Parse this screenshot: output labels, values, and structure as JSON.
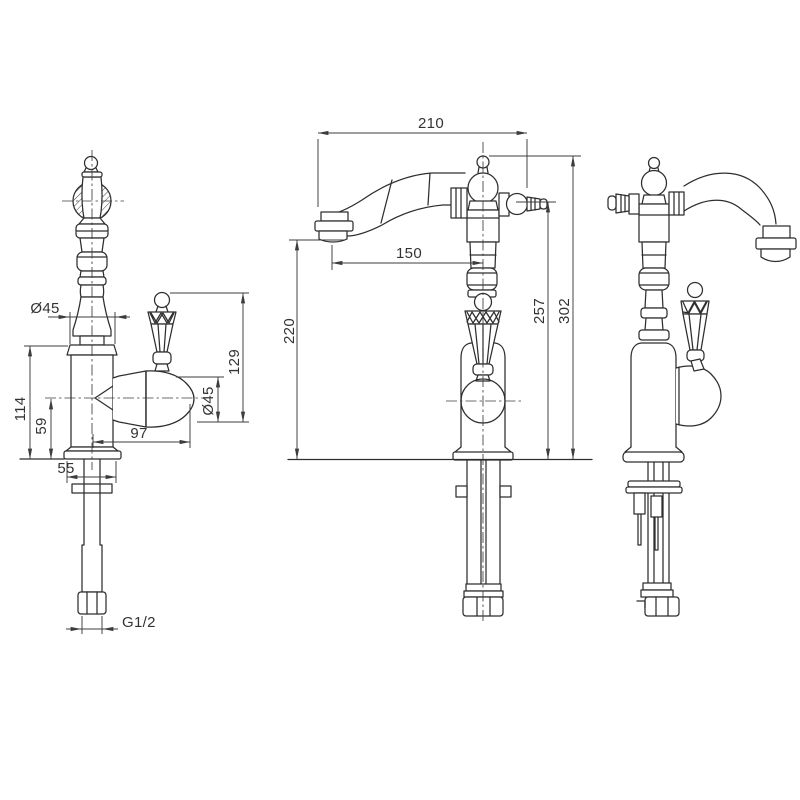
{
  "colors": {
    "line": "#2e2e2e",
    "dimension": "#3d3d3d",
    "background": "#ffffff"
  },
  "views": {
    "side": {
      "dims": {
        "spout_diameter": "Ø45",
        "body_top_height": "114",
        "valve_axis_height": "59",
        "handle_top_height": "129",
        "valve_diameter": "Ø45",
        "valve_reach": "97",
        "base_width": "55",
        "inlet_thread": "G1/2"
      }
    },
    "front": {
      "dims": {
        "spout_reach": "210",
        "outlet_offset": "150",
        "outlet_height": "220",
        "handle_axis_height": "257",
        "overall_height": "302"
      }
    }
  }
}
